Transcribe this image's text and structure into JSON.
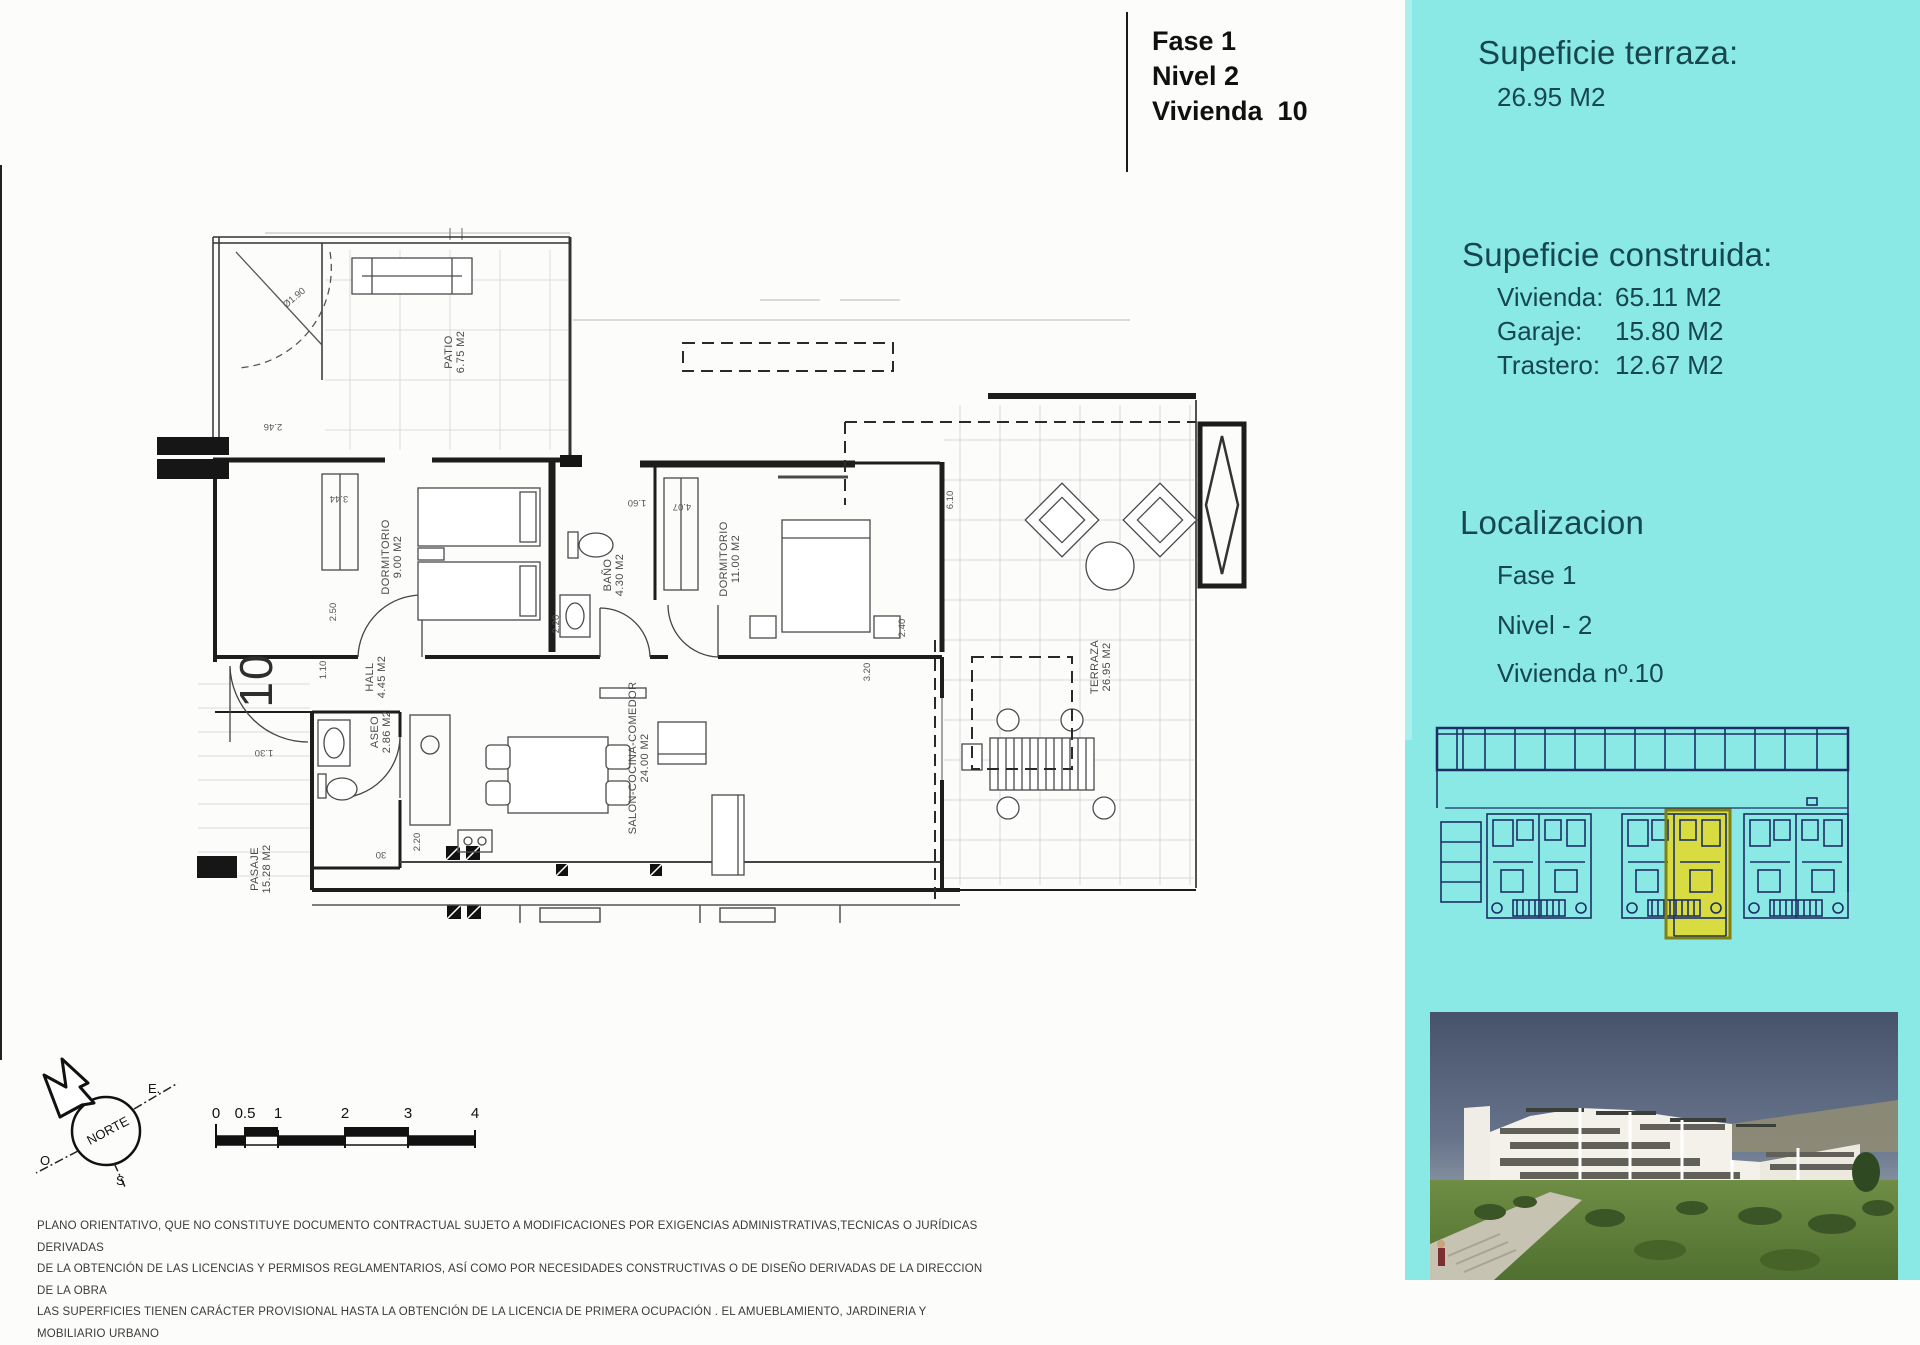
{
  "colors": {
    "panel_cyan": "#8AE9E4",
    "minimap_line": "#1C2F66",
    "highlight_yellow": "#D9DC41",
    "highlight_border": "#7E8018",
    "panel_text": "#16464F",
    "plan_line": "#1d1d1d"
  },
  "title_block": {
    "fase": "Fase 1",
    "nivel": "Nivel 2",
    "vivienda": "Vivienda  10"
  },
  "panel": {
    "terrace_heading": "Supeficie terraza:",
    "terrace_value": "26.95 M2",
    "built_heading": "Supeficie construida:",
    "built_rows": [
      {
        "label": "Vivienda:",
        "value": "65.11 M2"
      },
      {
        "label": "Garaje:",
        "value": "15.80 M2"
      },
      {
        "label": "Trastero:",
        "value": "12.67 M2"
      }
    ],
    "location_heading": "Localizacion",
    "location_lines": [
      "Fase 1",
      "Nivel - 2",
      "Vivienda nº.10"
    ]
  },
  "plan": {
    "unit_number": "10",
    "arc_label": "Ø1.90",
    "rooms": [
      {
        "name": "PATIO",
        "area": "6.75 M2"
      },
      {
        "name": "DORMITORIO",
        "area": "9.00 M2"
      },
      {
        "name": "BAÑO",
        "area": "4.30 M2"
      },
      {
        "name": "DORMITORIO",
        "area": "11.00 M2"
      },
      {
        "name": "HALL",
        "area": "4.45 M2"
      },
      {
        "name": "ASEO",
        "area": "2.86 M2"
      },
      {
        "name": "SALON-COCINA-COMEDOR",
        "area": "24.00 M2"
      },
      {
        "name": "TERRAZA",
        "area": "26.95 M2"
      },
      {
        "name": "PASAJE",
        "area": "15.28 M2"
      }
    ],
    "dims": [
      "2.46",
      "3.44",
      "2.50",
      "1.10",
      "1.60",
      "4.07",
      "6.10",
      "2.40",
      "3.20",
      "2.20",
      "2.20",
      "1.30",
      "30"
    ]
  },
  "compass": {
    "north": "NORTE",
    "east": "E.",
    "west": "O",
    "south": "S"
  },
  "scale_bar": {
    "labels": [
      "0",
      "0.5",
      "1",
      "2",
      "3",
      "4"
    ]
  },
  "disclaimer": {
    "lines": [
      "PLANO ORIENTATIVO, QUE NO CONSTITUYE DOCUMENTO CONTRACTUAL SUJETO A MODIFICACIONES POR EXIGENCIAS ADMINISTRATIVAS,TECNICAS O JURÍDICAS DERIVADAS",
      "DE LA OBTENCIÓN DE LAS LICENCIAS Y PERMISOS REGLAMENTARIOS, ASÍ COMO POR NECESIDADES CONSTRUCTIVAS  O DE DISEÑO DERIVADAS DE LA DIRECCION DE LA OBRA",
      "LAS SUPERFICIES TIENEN CARÁCTER PROVISIONAL HASTA LA OBTENCIÓN DE LA LICENCIA DE PRIMERA OCUPACIÓN . EL AMUEBLAMIENTO, JARDINERIA Y MOBILIARIO URBANO"
    ]
  }
}
